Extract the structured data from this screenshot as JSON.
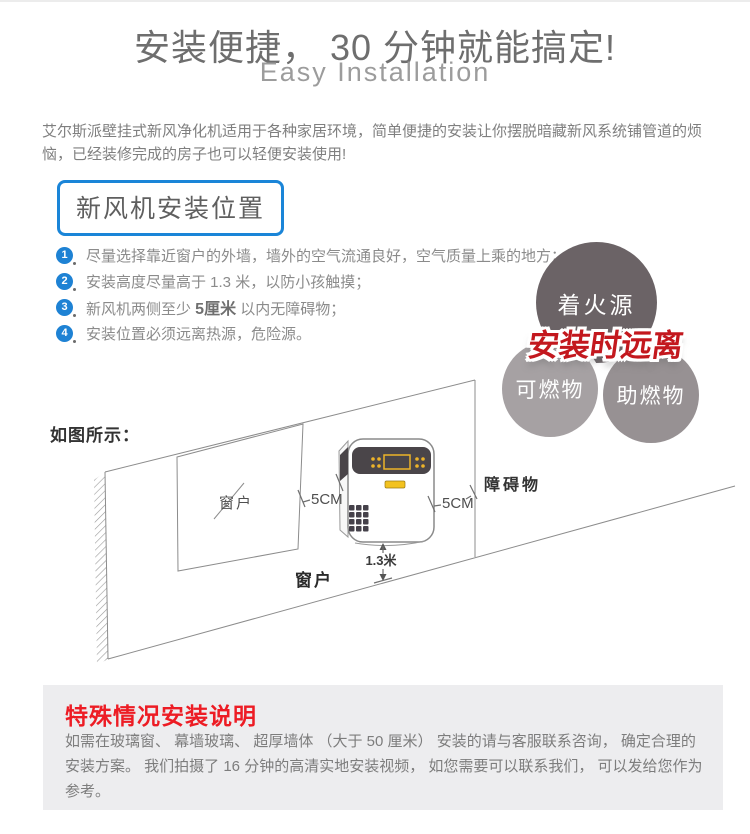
{
  "header": {
    "title": "安装便捷， 30 分钟就能搞定!",
    "subtitle": "Easy Installation"
  },
  "intro": "艾尔斯派壁挂式新风净化机适用于各种家居环境，简单便捷的安装让你摆脱暗藏新风系统铺管道的烦恼，已经装修完成的房子也可以轻便安装使用!",
  "section_box": "新风机安装位置",
  "install_points": [
    {
      "num": "1",
      "pre": "尽量选择靠近窗户的外墙，墙外的空气流通良好，空气质量上乘的地方；",
      "bold": "",
      "post": ""
    },
    {
      "num": "2",
      "pre": "安装高度尽量高于 1.3 米，以防小孩触摸；",
      "bold": "",
      "post": ""
    },
    {
      "num": "3",
      "pre": "新风机两侧至少 ",
      "bold": "5厘米",
      "post": " 以内无障碍物；"
    },
    {
      "num": "4",
      "pre": "安装位置必须远离热源，危险源。",
      "bold": "",
      "post": ""
    }
  ],
  "warning_circles": {
    "overlay": "安装时远离",
    "top": "着火源",
    "bottom_left": "可燃物",
    "bottom_right": "助燃物"
  },
  "diagram": {
    "label": "如图所示：",
    "window_inner": "窗户",
    "window_bottom": "窗户",
    "obstacle": "障碍物",
    "gap_left": "5CM",
    "gap_right": "5CM",
    "height": "1.3米"
  },
  "special": {
    "title": "特殊情况安装说明",
    "body": "如需在玻璃窗、 幕墙玻璃、 超厚墙体 （大于 50 厘米） 安装的请与客服联系咨询， 确定合理的安装方案。 我们拍摄了 16 分钟的高清实地安装视频， 如您需要可以联系我们， 可以发给您作为参考。"
  },
  "colors": {
    "accent_blue": "#1a85d8",
    "badge_blue": "#1e82d4",
    "alert_red": "#ed1c24",
    "overlay_red": "#c3181e",
    "circle_dark": "#6b6366",
    "circle_mid": "#979193",
    "circle_light": "#a6a1a3",
    "panel_gray": "#ededef",
    "device_yellow": "#edb329"
  }
}
